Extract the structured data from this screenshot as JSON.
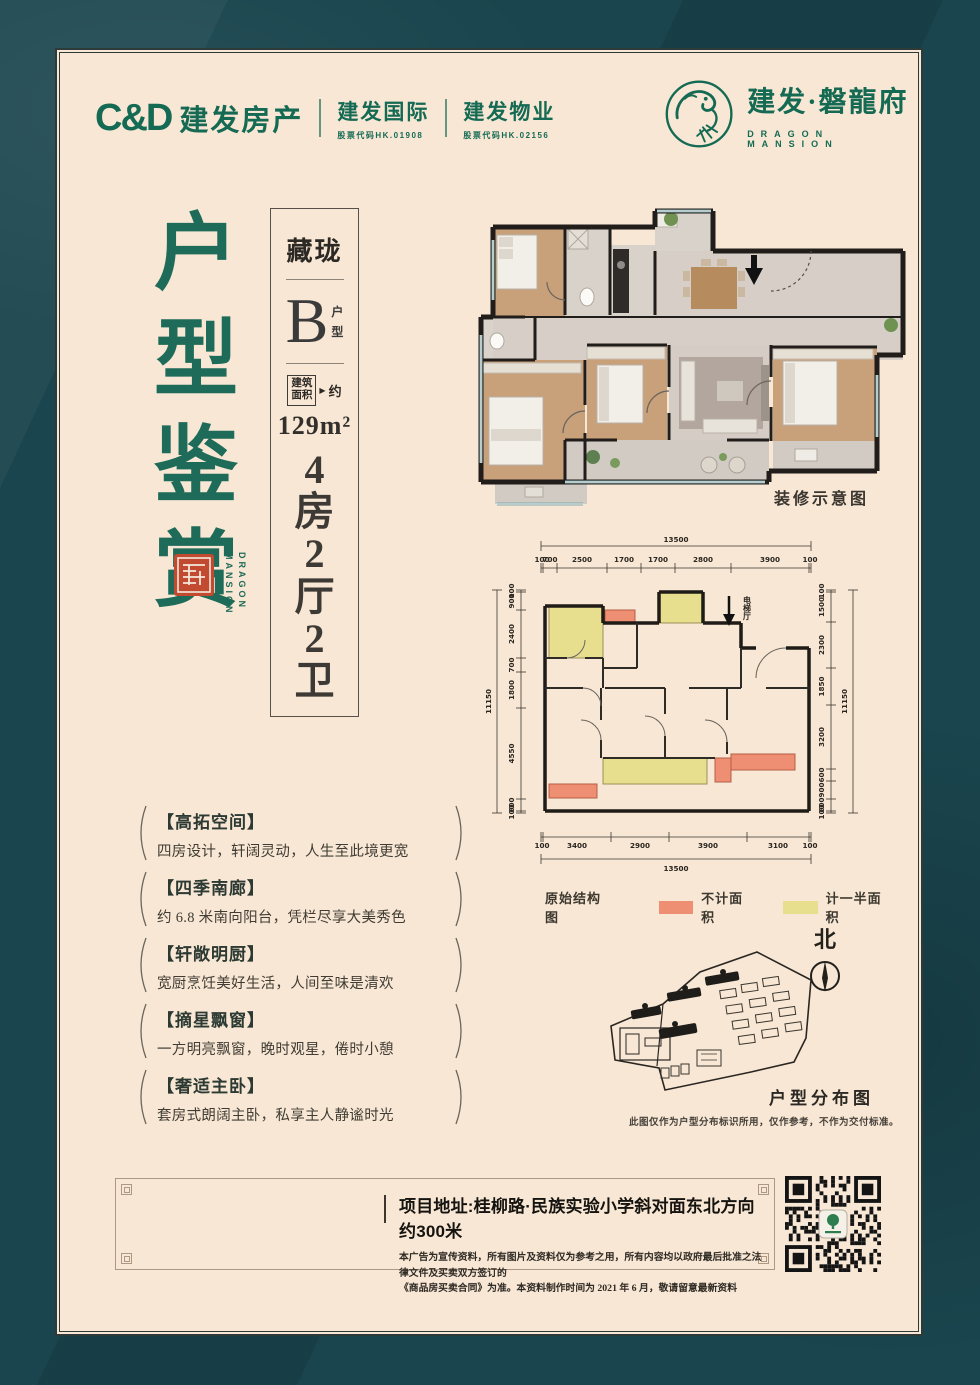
{
  "colors": {
    "teal_bg": "#1a454e",
    "cream_panel": "#f8e7d4",
    "brand_green": "#156a54",
    "title_green": "#1d6b58",
    "seal_red": "#c14a31",
    "not_counted": "#ee8e72",
    "half_counted": "#e7df8e"
  },
  "header": {
    "cnd_logo": "C&D",
    "brand_main": "建发房产",
    "brand_intl": "建发国际",
    "brand_intl_sub": "股票代码HK.01908",
    "brand_prop": "建发物业",
    "brand_prop_sub": "股票代码HK.02156",
    "project_name": "建发·磐龍府",
    "project_name_en": "DRAGON MANSION"
  },
  "title": {
    "text": "户型鉴赏",
    "seal_word1": "DRAGON",
    "seal_word2": "MANSION"
  },
  "unit_card": {
    "series": "藏珑",
    "type_letter": "B",
    "type_suffix_1": "户",
    "type_suffix_2": "型",
    "area_label_1": "建筑",
    "area_label_2": "面积",
    "area_approx": "约",
    "area_value": "129m²",
    "layout": "4房2厅2卫"
  },
  "render_plan": {
    "caption": "装修示意图"
  },
  "tech_plan": {
    "label": "原始结构图",
    "elevator_label": "电梯厅",
    "legend": [
      {
        "label": "不计面积",
        "color": "#ee8e72"
      },
      {
        "label": "计一半面积",
        "color": "#e7df8e"
      }
    ],
    "dims": {
      "top_total": "13500",
      "top": [
        "100",
        "700",
        "2500",
        "1700",
        "1700",
        "2800",
        "3900",
        "100"
      ],
      "bottom": [
        "100",
        "3400",
        "2900",
        "3900",
        "3100",
        "100"
      ],
      "bottom_total": "13500",
      "left_total": "11150",
      "left": [
        "100",
        "900",
        "2400",
        "700",
        "1800",
        "4550",
        "600",
        "100"
      ],
      "right": [
        "100",
        "1500",
        "2300",
        "1850",
        "3200",
        "600",
        "900",
        "600",
        "100"
      ],
      "right_total": "11150"
    }
  },
  "features": [
    {
      "title": "【高拓空间】",
      "desc": "四房设计，轩阔灵动，人生至此境更宽"
    },
    {
      "title": "【四季南廊】",
      "desc": "约 6.8 米南向阳台，凭栏尽享大美秀色"
    },
    {
      "title": "【轩敞明厨】",
      "desc": "宽厨烹饪美好生活，人间至味是清欢"
    },
    {
      "title": "【摘星飘窗】",
      "desc": "一方明亮飘窗，晚时观星，倦时小憩"
    },
    {
      "title": "【奢适主卧】",
      "desc": "套房式朗阔主卧，私享主人静谧时光"
    }
  ],
  "site_map": {
    "north_label": "北",
    "caption": "户型分布图",
    "disclaimer": "此图仅作为户型分布标识所用，仅作参考，不作为交付标准。"
  },
  "footer": {
    "address": "项目地址:桂柳路·民族实验小学斜对面东北方向约300米",
    "disclaimer_line1": "本广告为宣传资料，所有图片及资料仅为参考之用，所有内容均以政府最后批准之法律文件及买卖双方签订的",
    "disclaimer_line2": "《商品房买卖合同》为准。本资料制作时间为 2021 年 6 月，敬请留意最新资料"
  }
}
